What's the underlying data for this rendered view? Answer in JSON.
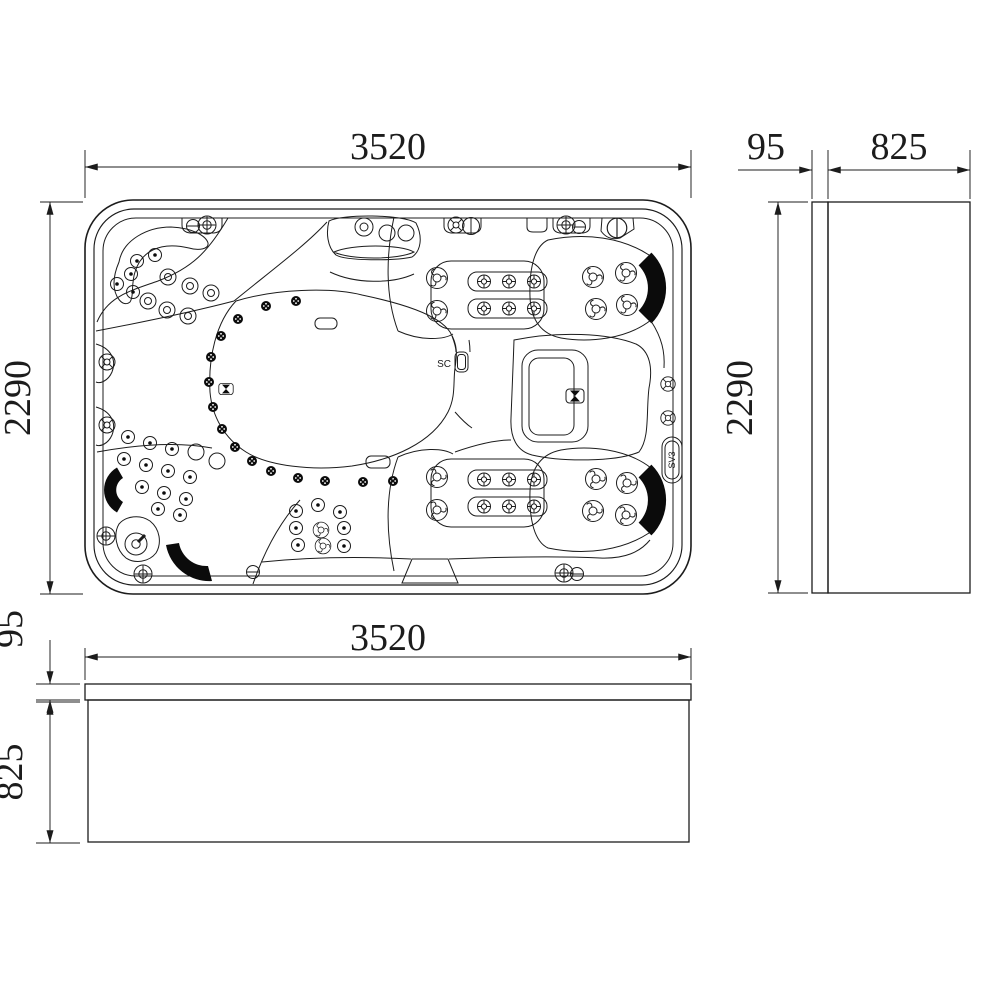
{
  "drawing": {
    "title": "spa-three-view-dimension-drawing",
    "background_color": "#ffffff",
    "line_color": "#1c1c1c",
    "views": [
      "plan-top-view",
      "side-view",
      "front-view"
    ]
  },
  "dims": {
    "plan_width": "3520",
    "plan_height": "2290",
    "side_height": "2290",
    "side_lip": "95",
    "side_depth": "825",
    "front_width": "3520",
    "front_lip": "95",
    "front_height": "825"
  },
  "labels": {
    "sc": "SC",
    "sv3": "SV3"
  }
}
